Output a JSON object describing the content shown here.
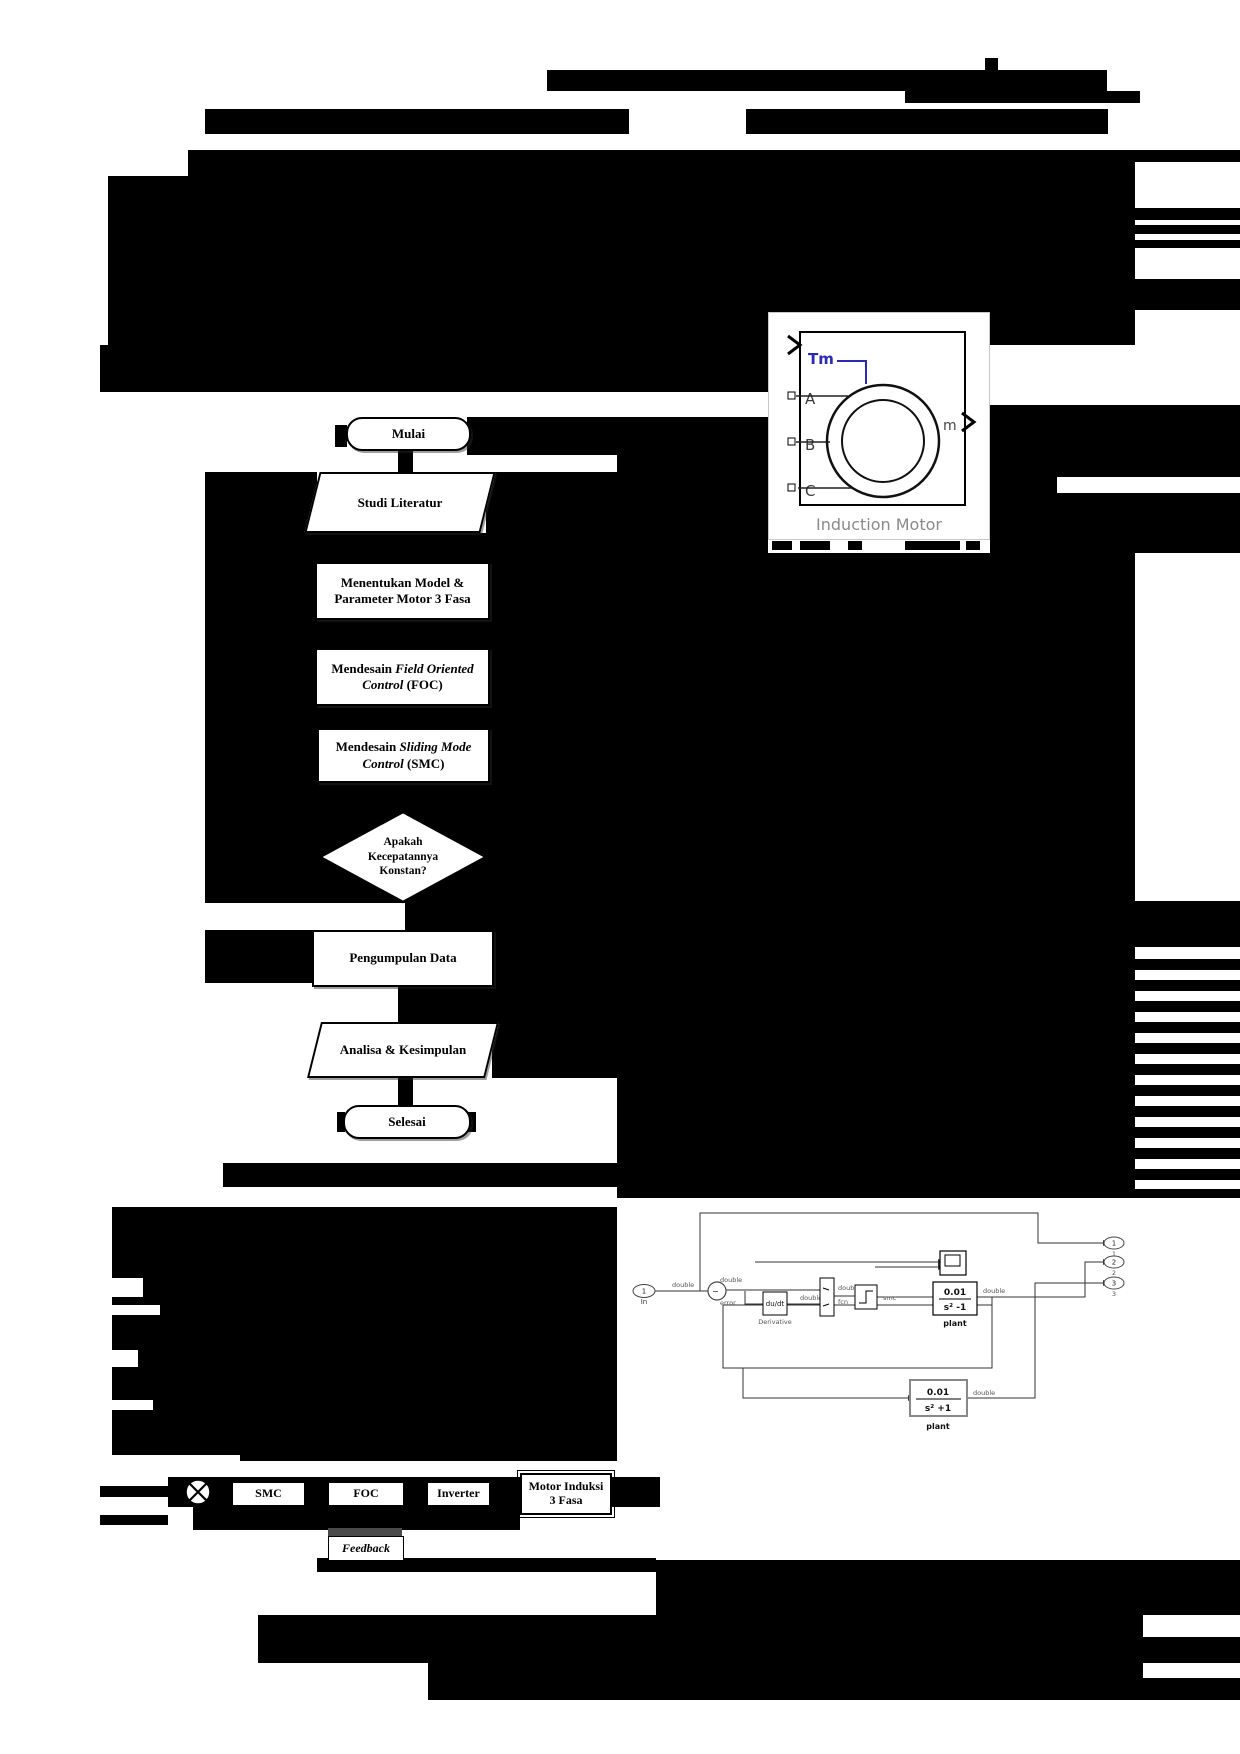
{
  "page": {
    "width": 1240,
    "height": 1754
  },
  "colors": {
    "redaction": "#000000",
    "tm_blue": "#2a2ab2",
    "figure_gray": "#8a8a8a"
  },
  "induction_motor_figure": {
    "ports": {
      "torque": "Tm",
      "a": "A",
      "b": "B",
      "c": "C",
      "out": "m"
    },
    "caption": "Induction Motor"
  },
  "flowchart": {
    "steps": [
      {
        "shape": "terminator",
        "label": "Mulai"
      },
      {
        "shape": "parallelogram",
        "label": "Studi Literatur"
      },
      {
        "shape": "process",
        "label": "Menentukan Model & Parameter Motor 3 Fasa"
      },
      {
        "shape": "process",
        "label_pre": "Mendesain ",
        "label_italic": "Field Oriented Control",
        "label_post": " (FOC)"
      },
      {
        "shape": "process",
        "label_pre": "Mendesain ",
        "label_italic": "Sliding Mode Control",
        "label_post": " (SMC)"
      },
      {
        "shape": "decision",
        "line1": "Apakah",
        "line2": "Kecepatannya",
        "line3": "Konstan?"
      },
      {
        "shape": "process",
        "label": "Pengumpulan Data"
      },
      {
        "shape": "parallelogram",
        "label": "Analisa & Kesimpulan"
      },
      {
        "shape": "terminator",
        "label": "Selesai"
      }
    ]
  },
  "simulink": {
    "inport": {
      "num": "1",
      "name": "In"
    },
    "labels": {
      "double": "double",
      "error": "error",
      "fcn": "fcn",
      "smc": "smc"
    },
    "derivative": {
      "text": "du/dt",
      "name": "Derivative"
    },
    "plant1": {
      "num": "0.01",
      "den": "s² -1",
      "name": "plant"
    },
    "plant2": {
      "num": "0.01",
      "den": "s² +1",
      "name": "plant"
    },
    "outports": {
      "o1": "1",
      "o2": "2",
      "o3": "3"
    }
  },
  "block_diagram": {
    "smc": "SMC",
    "foc": "FOC",
    "inverter": "Inverter",
    "motor_line1": "Motor Induksi",
    "motor_line2": "3 Fasa",
    "feedback": "Feedback"
  },
  "redactions": [
    {
      "x": 985,
      "y": 58,
      "w": 13,
      "h": 13
    },
    {
      "x": 547,
      "y": 70,
      "w": 560,
      "h": 21
    },
    {
      "x": 905,
      "y": 91,
      "w": 235,
      "h": 12
    },
    {
      "x": 205,
      "y": 109,
      "w": 424,
      "h": 25
    },
    {
      "x": 746,
      "y": 109,
      "w": 362,
      "h": 25
    },
    {
      "x": 108,
      "y": 150,
      "w": 1027,
      "h": 195
    },
    {
      "x": 108,
      "y": 150,
      "w": 80,
      "h": 26,
      "c": "w"
    },
    {
      "x": 1135,
      "y": 150,
      "w": 105,
      "h": 12
    },
    {
      "x": 1135,
      "y": 208,
      "w": 105,
      "h": 12
    },
    {
      "x": 1135,
      "y": 225,
      "w": 105,
      "h": 9
    },
    {
      "x": 1135,
      "y": 240,
      "w": 105,
      "h": 8
    },
    {
      "x": 1135,
      "y": 279,
      "w": 105,
      "h": 31
    },
    {
      "x": 100,
      "y": 345,
      "w": 668,
      "h": 47
    },
    {
      "x": 467,
      "y": 417,
      "w": 301,
      "h": 38
    },
    {
      "x": 335,
      "y": 425,
      "w": 12,
      "h": 22
    },
    {
      "x": 398,
      "y": 447,
      "w": 15,
      "h": 28
    },
    {
      "x": 205,
      "y": 472,
      "w": 112,
      "h": 61
    },
    {
      "x": 486,
      "y": 472,
      "w": 131,
      "h": 61
    },
    {
      "x": 205,
      "y": 533,
      "w": 412,
      "h": 29
    },
    {
      "x": 205,
      "y": 562,
      "w": 110,
      "h": 58
    },
    {
      "x": 490,
      "y": 562,
      "w": 127,
      "h": 58
    },
    {
      "x": 205,
      "y": 620,
      "w": 412,
      "h": 28
    },
    {
      "x": 205,
      "y": 648,
      "w": 110,
      "h": 58
    },
    {
      "x": 490,
      "y": 648,
      "w": 127,
      "h": 58
    },
    {
      "x": 205,
      "y": 706,
      "w": 412,
      "h": 22
    },
    {
      "x": 205,
      "y": 728,
      "w": 112,
      "h": 55
    },
    {
      "x": 490,
      "y": 728,
      "w": 127,
      "h": 55
    },
    {
      "x": 205,
      "y": 783,
      "w": 412,
      "h": 27
    },
    {
      "x": 205,
      "y": 810,
      "w": 412,
      "h": 93
    },
    {
      "x": 405,
      "y": 903,
      "w": 212,
      "h": 27
    },
    {
      "x": 205,
      "y": 930,
      "w": 107,
      "h": 53
    },
    {
      "x": 490,
      "y": 930,
      "w": 127,
      "h": 53
    },
    {
      "x": 398,
      "y": 983,
      "w": 15,
      "h": 39
    },
    {
      "x": 413,
      "y": 983,
      "w": 204,
      "h": 39
    },
    {
      "x": 492,
      "y": 1022,
      "w": 125,
      "h": 56
    },
    {
      "x": 398,
      "y": 1078,
      "w": 15,
      "h": 27
    },
    {
      "x": 337,
      "y": 1112,
      "w": 8,
      "h": 20
    },
    {
      "x": 467,
      "y": 1112,
      "w": 9,
      "h": 20
    },
    {
      "x": 617,
      "y": 455,
      "w": 151,
      "h": 98
    },
    {
      "x": 990,
      "y": 405,
      "w": 250,
      "h": 148
    },
    {
      "x": 1057,
      "y": 477,
      "w": 183,
      "h": 16,
      "c": "w"
    },
    {
      "x": 772,
      "y": 541,
      "w": 20,
      "h": 9
    },
    {
      "x": 800,
      "y": 541,
      "w": 30,
      "h": 9
    },
    {
      "x": 848,
      "y": 541,
      "w": 14,
      "h": 9
    },
    {
      "x": 905,
      "y": 541,
      "w": 55,
      "h": 9
    },
    {
      "x": 966,
      "y": 541,
      "w": 14,
      "h": 9
    },
    {
      "x": 617,
      "y": 553,
      "w": 518,
      "h": 348
    },
    {
      "x": 617,
      "y": 901,
      "w": 623,
      "h": 46
    },
    {
      "x": 617,
      "y": 947,
      "w": 518,
      "h": 251
    },
    {
      "x": 1135,
      "y": 959,
      "w": 105,
      "h": 11
    },
    {
      "x": 1135,
      "y": 980,
      "w": 105,
      "h": 11
    },
    {
      "x": 1135,
      "y": 1001,
      "w": 105,
      "h": 11
    },
    {
      "x": 1135,
      "y": 1022,
      "w": 105,
      "h": 11
    },
    {
      "x": 1135,
      "y": 1043,
      "w": 105,
      "h": 11
    },
    {
      "x": 1135,
      "y": 1064,
      "w": 105,
      "h": 11
    },
    {
      "x": 1135,
      "y": 1085,
      "w": 105,
      "h": 11
    },
    {
      "x": 1135,
      "y": 1106,
      "w": 105,
      "h": 11
    },
    {
      "x": 1135,
      "y": 1127,
      "w": 105,
      "h": 11
    },
    {
      "x": 1135,
      "y": 1148,
      "w": 105,
      "h": 11
    },
    {
      "x": 1135,
      "y": 1169,
      "w": 105,
      "h": 11
    },
    {
      "x": 1135,
      "y": 1189,
      "w": 105,
      "h": 9
    },
    {
      "x": 223,
      "y": 1163,
      "w": 394,
      "h": 24
    },
    {
      "x": 112,
      "y": 1207,
      "w": 505,
      "h": 248
    },
    {
      "x": 240,
      "y": 1455,
      "w": 377,
      "h": 6
    },
    {
      "x": 112,
      "y": 1278,
      "w": 31,
      "h": 19,
      "c": "w"
    },
    {
      "x": 112,
      "y": 1305,
      "w": 48,
      "h": 10,
      "c": "w"
    },
    {
      "x": 112,
      "y": 1350,
      "w": 26,
      "h": 17,
      "c": "w"
    },
    {
      "x": 112,
      "y": 1400,
      "w": 41,
      "h": 10,
      "c": "w"
    },
    {
      "x": 100,
      "y": 1486,
      "w": 68,
      "h": 11
    },
    {
      "x": 100,
      "y": 1515,
      "w": 68,
      "h": 10
    },
    {
      "x": 168,
      "y": 1477,
      "w": 492,
      "h": 30
    },
    {
      "x": 193,
      "y": 1507,
      "w": 327,
      "h": 23
    },
    {
      "x": 610,
      "y": 1488,
      "w": 50,
      "h": 19
    },
    {
      "x": 317,
      "y": 1558,
      "w": 339,
      "h": 14
    },
    {
      "x": 656,
      "y": 1560,
      "w": 584,
      "h": 55
    },
    {
      "x": 258,
      "y": 1615,
      "w": 885,
      "h": 48
    },
    {
      "x": 1143,
      "y": 1637,
      "w": 97,
      "h": 26
    },
    {
      "x": 428,
      "y": 1663,
      "w": 715,
      "h": 37
    },
    {
      "x": 1143,
      "y": 1678,
      "w": 97,
      "h": 22
    }
  ]
}
